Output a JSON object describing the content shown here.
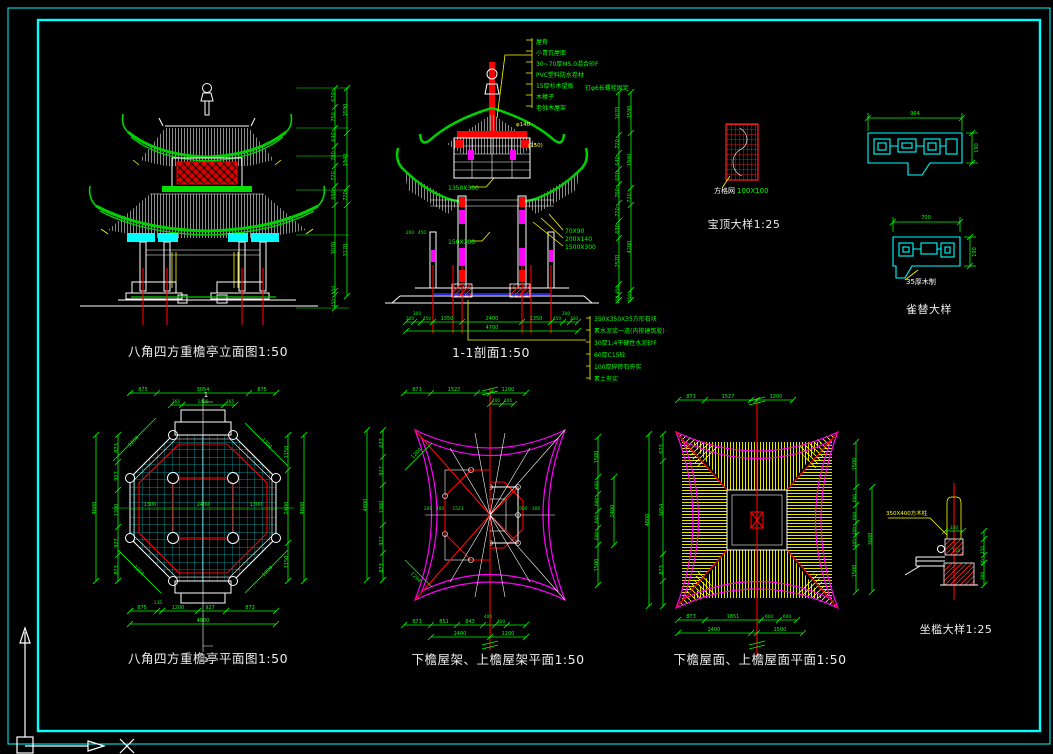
{
  "window": {
    "background": "#000000",
    "frame_color": "#00ffff"
  },
  "drawings": {
    "elevation": {
      "title": "八角四方重檐亭立面图1:50",
      "dims_inner": [
        "670",
        "750",
        "640",
        "700",
        "720",
        "690",
        "3070",
        "150",
        "450"
      ],
      "dims_outer": [
        "1590",
        "1940",
        "720",
        "3170"
      ]
    },
    "section": {
      "title": "1-1剖面1:50",
      "callouts_top": [
        "屋脊",
        "小青瓦屋面",
        "30~70厚M5.0混合砂F",
        "PVC塑料防水卷材",
        "15厚杉木望板",
        "木椽子",
        "老戗木屋架"
      ],
      "callout_note": "钉φ6长螺栓固定",
      "labels_left": [
        "1350X300",
        "150X300"
      ],
      "labels_right": [
        "70X90",
        "200X140",
        "1500X300"
      ],
      "labels_yellow": [
        "φ140",
        "(150)"
      ],
      "callouts_bottom": [
        "350X350X35方形石块",
        "素水泥浆一道(内掺建筑胶)",
        "30厚1:4干硬性水泥砂F",
        "60厚C15砼",
        "100厚碎砖石夯实",
        "素土夯实"
      ],
      "dims_bottom": [
        "300",
        "300",
        "450",
        "1350",
        "2400",
        "1350",
        "450",
        "300",
        "300"
      ],
      "dim_total": "4700",
      "dims_left_small": [
        "200",
        "450"
      ],
      "dims_right_inner": [
        "1670",
        "720",
        "640",
        "600",
        "760",
        "720",
        "690",
        "2570",
        "450",
        "150"
      ],
      "dims_right_outer": [
        "1590",
        "1940",
        "720",
        "4200",
        "450"
      ]
    },
    "baoding": {
      "title": "宝顶大样1:25",
      "label_white": "方格网",
      "label_green": "100X100"
    },
    "queti": {
      "title": "雀替大样",
      "label": "35厚木制",
      "dim_width_1": "964",
      "dim_width_2": "700",
      "dim_height_1": "190",
      "dim_height_2": "190"
    },
    "plan": {
      "title": "八角四方重檐亭平面图1:50",
      "section_marker": "1",
      "dims_top_row1": [
        "875",
        "3054",
        "875"
      ],
      "dims_top_row2": [
        "365",
        "1400",
        "365"
      ],
      "dims_left": [
        "873",
        "927",
        "1300",
        "927",
        "873"
      ],
      "dim_left_total": "4800",
      "dims_right": [
        "1150",
        "2400",
        "1150"
      ],
      "dim_right_total": "4800",
      "dims_bottom_row1": [
        "875",
        "135",
        "1200",
        "927",
        "873"
      ],
      "dim_bottom_total": "4800",
      "dims_mid": [
        "1300",
        "2400",
        "1300"
      ],
      "dims_diagonal": [
        "1204",
        "1204",
        "1204",
        "1204"
      ]
    },
    "roof_frame": {
      "title": "下檐屋架、上檐屋架平面1:50",
      "dims_top": [
        "873",
        "1527",
        "1200"
      ],
      "dims_top_row2": [
        "400",
        "400"
      ],
      "dims_left": [
        "673",
        "927",
        "1300",
        "927",
        "873"
      ],
      "dim_left_total": "4800",
      "dims_right": [
        "1500",
        "600",
        "600",
        "600",
        "600",
        "1500"
      ],
      "dim_right_total": "2400",
      "dims_bottom": [
        "873",
        "851",
        "843",
        "400",
        "400"
      ],
      "dims_bottom_row2": [
        "2400",
        "1200"
      ],
      "dims_inner_left": [
        "200",
        "400",
        "1523"
      ],
      "dims_inner_right": [
        "1000",
        "300"
      ],
      "dims_diagonal": [
        "1204",
        "1294"
      ]
    },
    "roof_surface": {
      "title": "下檐屋面、上檐屋面平面1:50",
      "dims_top": [
        "873",
        "1527",
        "1200"
      ],
      "dims_left": [
        "673",
        "3054",
        "873"
      ],
      "dim_left_total": "4800",
      "dims_right": [
        "1500",
        "600",
        "600",
        "400",
        "400",
        "1500"
      ],
      "dim_right_total": "3600",
      "dims_bottom": [
        "873",
        "1851",
        "600",
        "600"
      ],
      "dims_bottom_row2": [
        "2400",
        "1500"
      ]
    },
    "zuokan": {
      "title": "坐槛大样1:25",
      "label": "350X400方木柱",
      "dims": [
        "330",
        "110",
        "450",
        "90",
        "300"
      ]
    }
  }
}
